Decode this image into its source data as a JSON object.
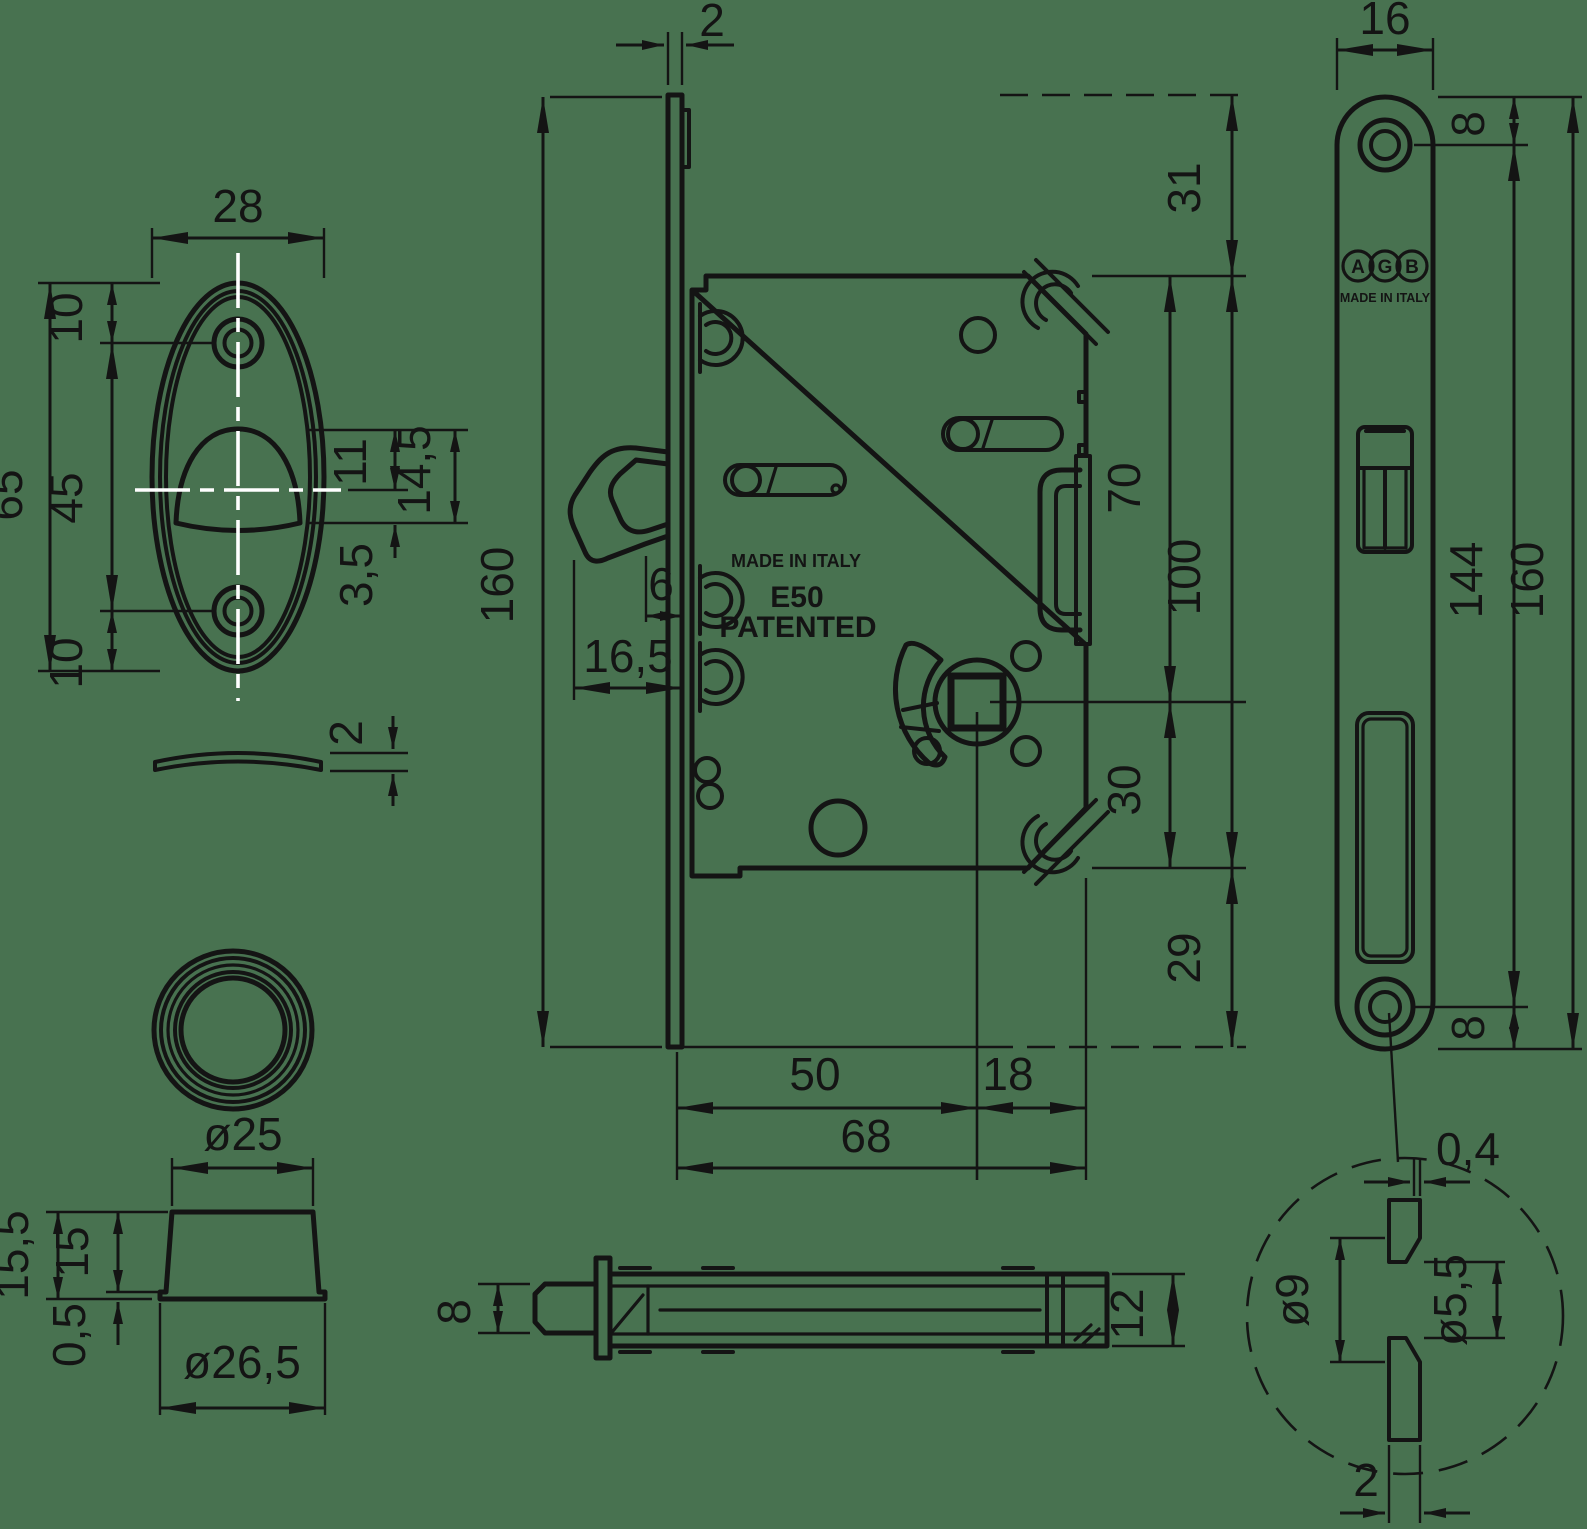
{
  "meta": {
    "background": "#487250",
    "line_color": "#141414",
    "centerline_color": "#ffffff"
  },
  "escutcheon_front": {
    "dims": {
      "width": "28",
      "hole_top": "10",
      "height": "65",
      "hole_spacing": "45",
      "hole_bottom": "10",
      "recess_upper": "11",
      "recess_total": "14,5",
      "recess_lower": "3,5"
    }
  },
  "escutcheon_side": {
    "dims": {
      "thickness": "2"
    }
  },
  "cup_side": {
    "dims": {
      "top_diameter": "ø25",
      "height_total": "15,5",
      "height_body": "15",
      "flange_height": "0,5",
      "flange_diameter": "ø26,5"
    }
  },
  "lock_main": {
    "texts": {
      "made_in_italy": "MADE IN ITALY",
      "model": "E50",
      "patented": "PATENTED"
    },
    "dims": {
      "faceplate_thickness": "2",
      "faceplate_height": "160",
      "hook_offset": "6",
      "hook_inset": "16,5",
      "top_margin": "31",
      "spindle_from_top": "70",
      "case_height": "100",
      "spindle_to_bottom": "30",
      "bottom_margin": "29",
      "backset": "50",
      "case_extra": "18",
      "case_depth": "68"
    }
  },
  "faceplate_front": {
    "texts": {
      "brand_a": "A",
      "brand_g": "G",
      "brand_b": "B",
      "made_in_italy": "MADE IN ITALY"
    },
    "dims": {
      "width": "16",
      "hole_top_offset": "8",
      "hole_spacing": "144",
      "height": "160",
      "hole_bottom_offset": "8"
    }
  },
  "lock_side": {
    "dims": {
      "hook_height": "8",
      "case_thickness": "12"
    }
  },
  "hole_detail": {
    "dims": {
      "land": "0,4",
      "countersink_diameter": "ø9",
      "hole_diameter": "ø5,5",
      "plate_thickness": "2"
    }
  }
}
